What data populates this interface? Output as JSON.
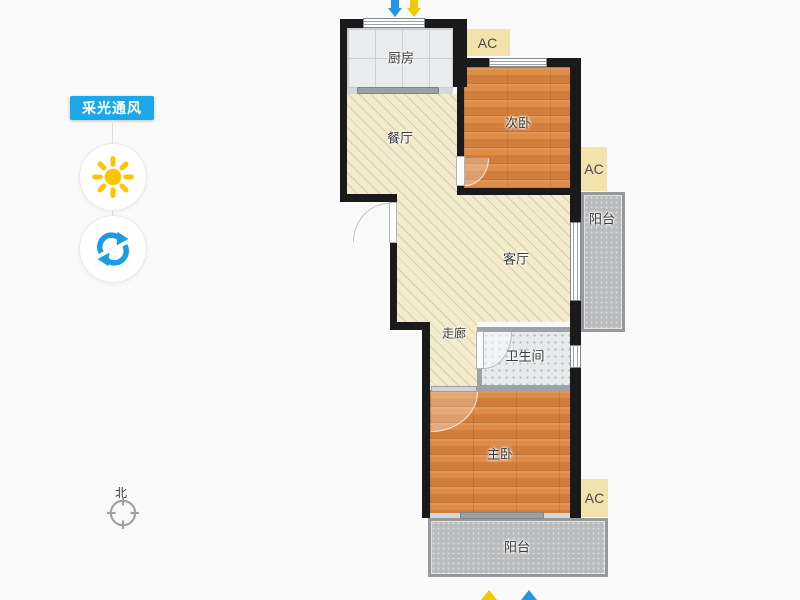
{
  "sidebar": {
    "panel_label": "采光通风",
    "compass_label": "北"
  },
  "floorplan": {
    "rooms": {
      "kitchen": "厨房",
      "dining": "餐厅",
      "bedroom_second": "次卧",
      "living": "客厅",
      "balcony_east": "阳台",
      "corridor": "走廊",
      "bathroom": "卫生间",
      "bedroom_master": "主卧",
      "balcony_south": "阳台"
    },
    "ac_units": [
      {
        "label": "AC"
      },
      {
        "label": "AC"
      },
      {
        "label": "AC"
      }
    ]
  },
  "icons": {
    "sun": "sun-icon",
    "refresh": "refresh-icon",
    "compass": "compass-icon",
    "wind_in": "arrow-down-icon",
    "wind_out": "arrow-up-icon"
  },
  "colors": {
    "accent_blue": "#1BA7E8",
    "sun_yellow": "#FFC400",
    "arrow_blue": "#2196E8",
    "arrow_yellow": "#F0C800",
    "wall_black": "#1A1A1A",
    "wood_floor": "#D98440",
    "hatch_floor": "#F3EBCD",
    "ac_beige": "#F2E3AC",
    "balcony_gray": "#B9BBBD"
  }
}
